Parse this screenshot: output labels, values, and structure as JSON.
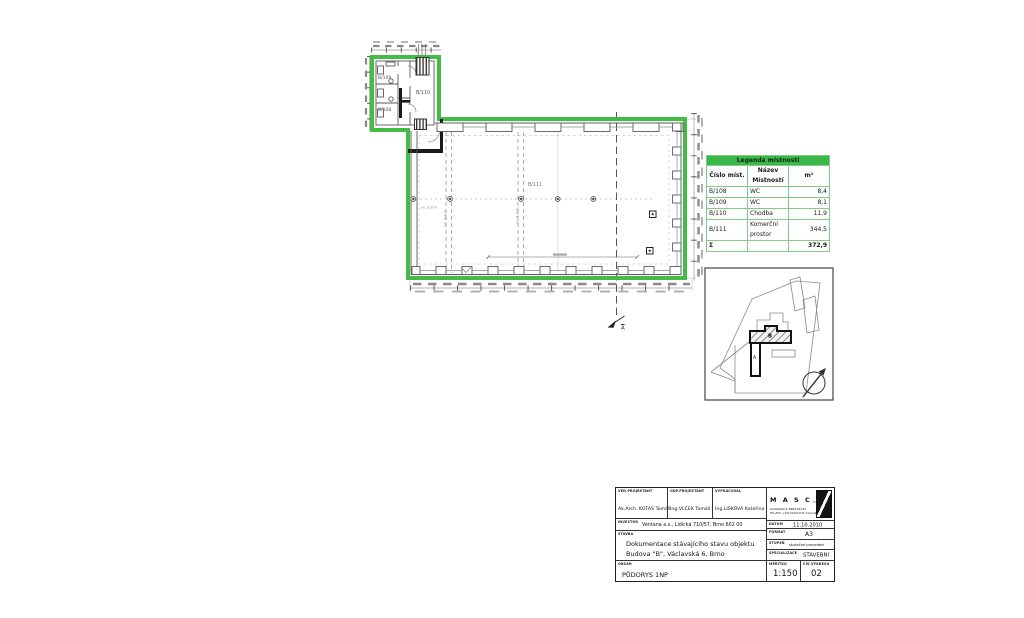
{
  "colors": {
    "outline_green": "#44bb44",
    "legend_header_green": "#3cb84a",
    "wall_gray": "#5a5a5a",
    "dim_gray": "#8a8a8a"
  },
  "legend": {
    "title": "Legenda místností",
    "col_id": "Číslo míst.",
    "col_name": "Název Místností",
    "col_area": "m²",
    "rows": [
      {
        "id": "B/108",
        "name": "WC",
        "area": "8,4"
      },
      {
        "id": "B/109",
        "name": "WC",
        "area": "8,1"
      },
      {
        "id": "B/110",
        "name": "Chodba",
        "area": "11,9"
      },
      {
        "id": "B/111",
        "name": "Komerční prostor",
        "area": "344,5"
      }
    ],
    "sum_symbol": "Σ",
    "sum_area": "372,9"
  },
  "plan": {
    "rooms": {
      "b108": "B/108",
      "b109": "B/109",
      "b110": "B/110",
      "b111": "B/111"
    },
    "height_note_1": "sv. 3,8 m",
    "height_note_2": "sv. 3,8 m",
    "height_note_3": "sv. 3,8 m",
    "section_label": "A"
  },
  "site": {
    "building_b": "B",
    "building_a": "A"
  },
  "title_block": {
    "ved_label": "VED.PROJEKTANT",
    "ved": "Ak.Arch. KOTAS Tomáš",
    "odp_label": "ODP.PROJEKTANT",
    "odp": "Ing.VLČEK Tomáš",
    "vyp_label": "VYPRACOVAL",
    "vyp": "Ing.LIŠKOVÁ Kateřina",
    "investor_label": "INVESTOR",
    "investor": "Ventana a.s., Lidická 710/57, Brno 602 00",
    "stavba_label": "STAVBA",
    "stavba_line1": "Dokumentace stávajícího stavu objektu",
    "stavba_line2": "Budova \"B\", Václavská 6, Brno",
    "obsah_label": "OBSAH",
    "obsah": "PŮDORYS 1NP",
    "firm_name": "M A S C O",
    "firm_suffix": "s.r.o.",
    "firm_addr1": "SLOVÁKOVA 8, BRNO 602 00",
    "firm_addr2": "TEL./FAX: +420 541213711  masco@masco.cz",
    "datum_label": "DATUM",
    "datum": "11.10.2010",
    "format_label": "FORMÁT",
    "format": "A3",
    "stupen_label": "STUPEŇ",
    "stupen": "skutečné provedení",
    "specializace_label": "SPECIALIZACE",
    "specializace": "STAVEBNÍ",
    "meritko_label": "MĚŘÍTKO",
    "meritko": "1:150",
    "cis_label": "ČÍS.VÝKRESU",
    "cis": "02"
  }
}
